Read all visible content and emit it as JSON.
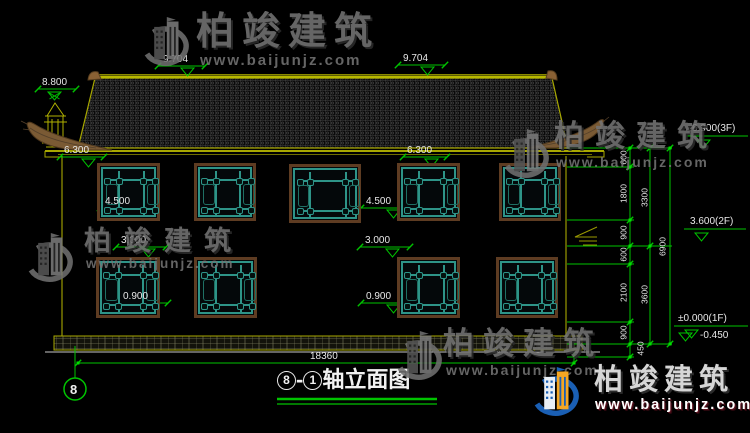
{
  "watermark": {
    "brand": "柏竣建筑",
    "site": "www.baijunjz.com"
  },
  "title": {
    "axis_from": "8",
    "dash": "-",
    "axis_to": "1",
    "label": "轴立面图"
  },
  "axis": {
    "bubble": "8"
  },
  "levels": {
    "ridge": "9.704",
    "finial": "8.800",
    "eave": "6.300",
    "sill_2f": "4.500",
    "head_1f": "3.000",
    "sill_1f": "0.900"
  },
  "floor_marks": {
    "f3": "6.900(3F)",
    "f2": "3.600(2F)",
    "f1": "±0.000(1F)",
    "ground": "-0.450"
  },
  "dims": {
    "total_width": "18360",
    "chain_segments": [
      "600",
      "1800",
      "900",
      "600",
      "2100",
      "900",
      "450"
    ],
    "chain_sums": [
      "3300",
      "3600"
    ],
    "chain_total": "6900"
  }
}
